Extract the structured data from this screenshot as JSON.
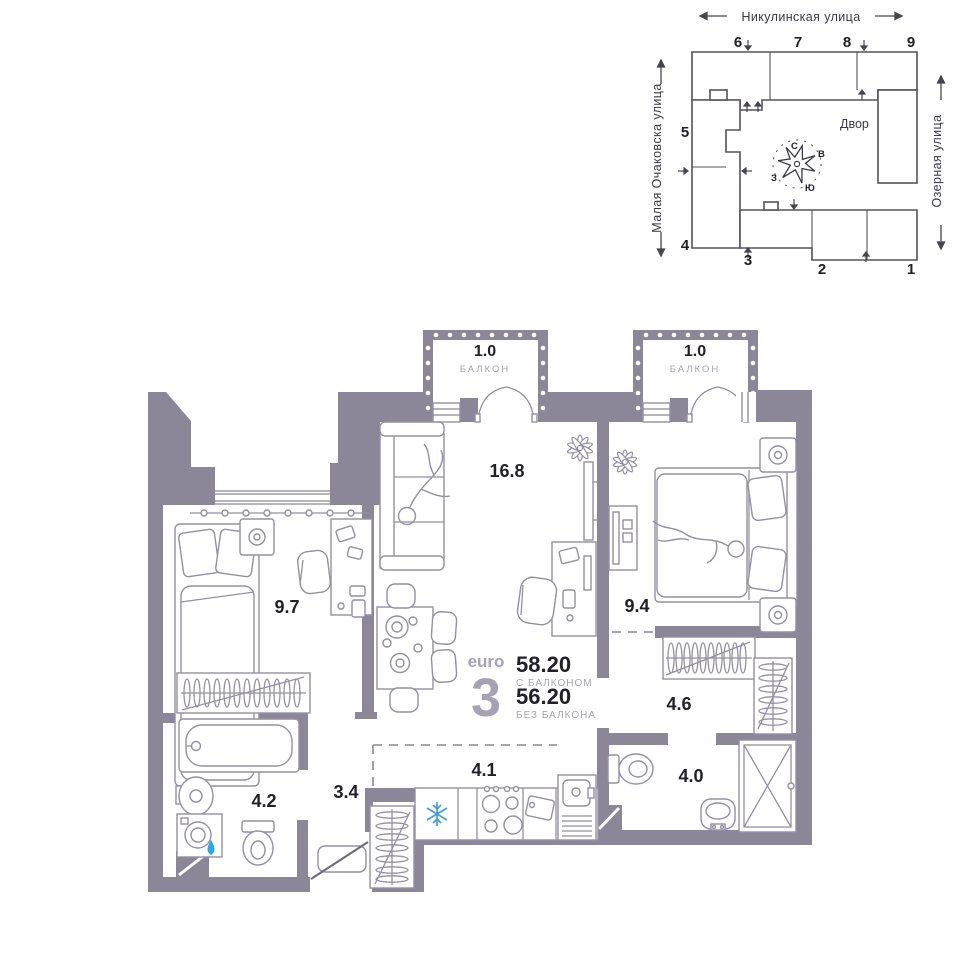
{
  "site_plan": {
    "street_top": "Никулинская улица",
    "street_left": "Малая Очаковска улица",
    "street_right": "Озерная улица",
    "courtyard_label": "Двор",
    "compass": {
      "north": "С",
      "east": "В",
      "south": "Ю",
      "west": "З"
    },
    "building_numbers": [
      "1",
      "2",
      "3",
      "4",
      "5",
      "6",
      "7",
      "8",
      "9"
    ]
  },
  "apartment": {
    "type_prefix": "euro",
    "type_number": "3",
    "area_with_balcony": "58.20",
    "area_with_balcony_label": "С БАЛКОНОМ",
    "area_without_balcony": "56.20",
    "area_without_balcony_label": "БЕЗ БАЛКОНА",
    "rooms": [
      {
        "id": "living-room",
        "area": "16.8"
      },
      {
        "id": "bedroom-1",
        "area": "9.7"
      },
      {
        "id": "bedroom-2",
        "area": "9.4"
      },
      {
        "id": "wardrobe",
        "area": "4.6"
      },
      {
        "id": "kitchen",
        "area": "4.1"
      },
      {
        "id": "bathroom",
        "area": "4.2"
      },
      {
        "id": "hallway",
        "area": "3.4"
      },
      {
        "id": "shower-room",
        "area": "4.0"
      },
      {
        "id": "balcony-1",
        "area": "1.0",
        "label": "БАЛКОН"
      },
      {
        "id": "balcony-2",
        "area": "1.0",
        "label": "БАЛКОН"
      }
    ],
    "colors": {
      "wall": "#8b8698",
      "furniture_outline": "#948fa3",
      "accent_snowflake": "#3f9fd8",
      "accent_drop": "#29abe2",
      "text_dark": "#232127",
      "text_muted": "#a7a2b2"
    }
  }
}
